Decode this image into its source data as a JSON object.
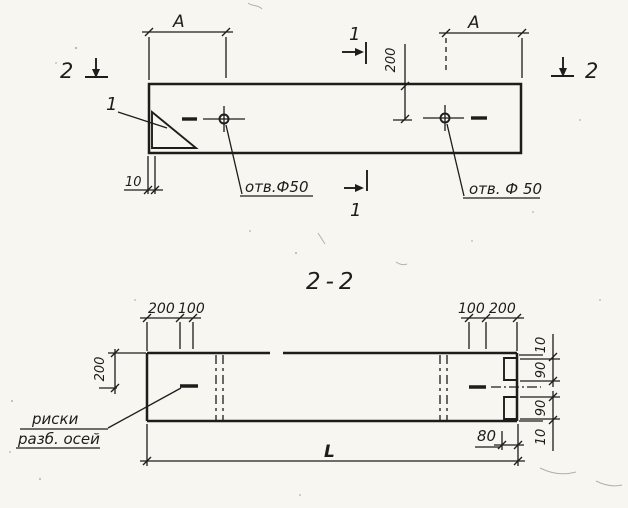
{
  "drawing": {
    "plan_view": {
      "span_label_left": "А",
      "span_label_right": "А",
      "section_mark_2_left": "2",
      "section_mark_2_right": "2",
      "section_mark_1_top": "1",
      "section_mark_1_bottom": "1",
      "corner_detail_ref": "1",
      "hole_offset_dim": "200",
      "edge_offset_dim": "10",
      "hole_label_left": "отв.Ф50",
      "hole_label_right": "отв. Ф 50"
    },
    "section_view": {
      "title": "2-2",
      "top_dims_left": [
        "200",
        "100"
      ],
      "top_dims_right": [
        "100",
        "200"
      ],
      "axis_offset_dim": "200",
      "right_dims": [
        "10",
        "90",
        "90",
        "10"
      ],
      "notch_depth_dim": "80",
      "length_dim": "L",
      "axis_note_line1": "риски",
      "axis_note_line2": "разб. осей"
    },
    "ink_color": "#1d1d1b",
    "paper_color": "#f7f6f1"
  }
}
